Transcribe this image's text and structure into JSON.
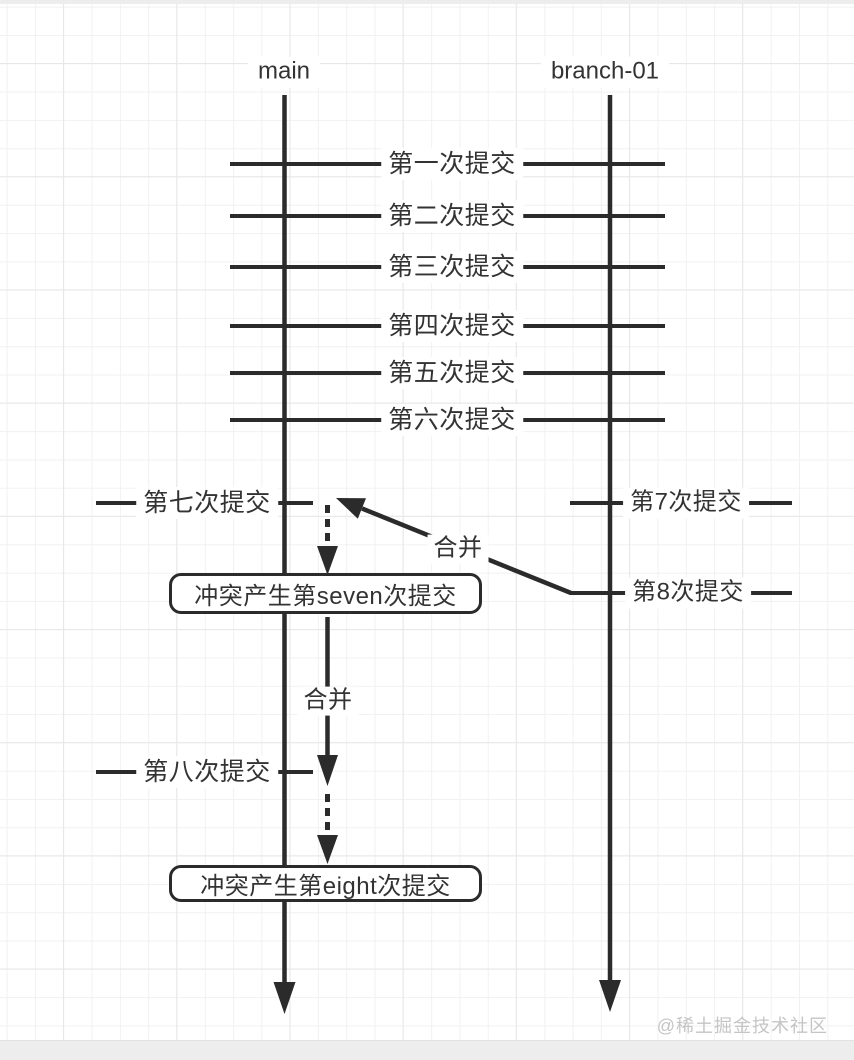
{
  "diagram": {
    "branches": [
      {
        "label": "main"
      },
      {
        "label": "branch-01"
      }
    ],
    "shared_commits": [
      "第一次提交",
      "第二次提交",
      "第三次提交",
      "第四次提交",
      "第五次提交",
      "第六次提交"
    ],
    "main_branch": {
      "seventh_commit": "第七次提交",
      "eighth_commit": "第八次提交"
    },
    "branch_01": {
      "seventh_commit": "第7次提交",
      "eighth_commit": "第8次提交"
    },
    "merges": {
      "merge_1_label": "合并",
      "merge_2_label": "合并"
    },
    "conflict_boxes": {
      "box_1": "冲突产生第seven次提交",
      "box_2": "冲突产生第eight次提交"
    },
    "watermark": "@稀土掘金技术社区",
    "colors": {
      "line": "#2b2b2b",
      "text": "#333333",
      "grid_minor": "#f1f1f1",
      "grid_major": "#e7e7e7",
      "edge_band": "#ededed",
      "watermark": "#c5c5c5"
    }
  }
}
